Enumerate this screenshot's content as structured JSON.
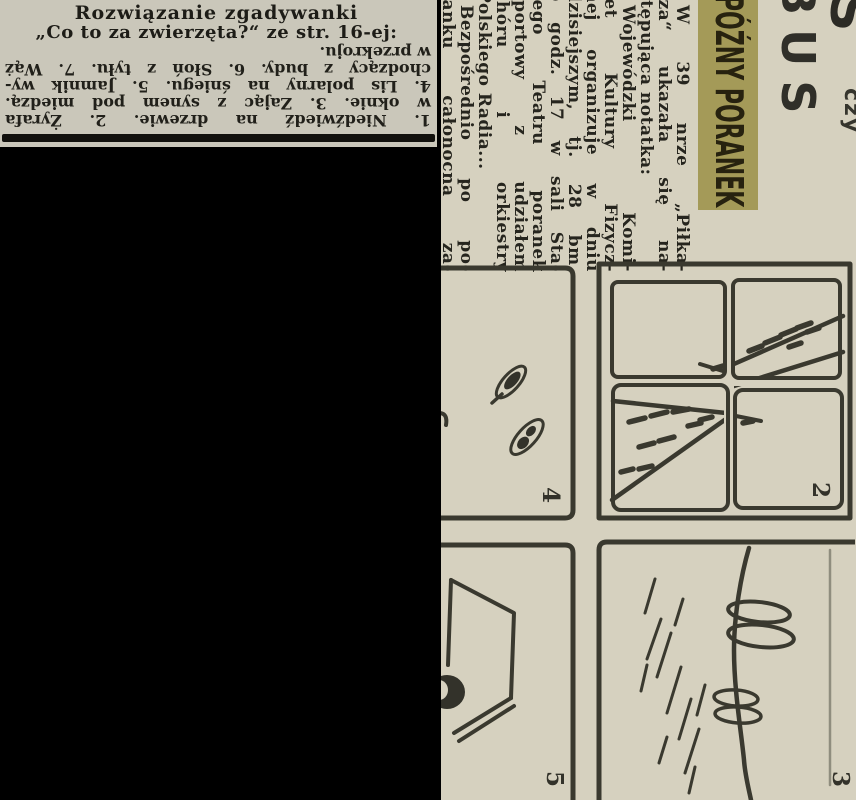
{
  "clipping": {
    "title_line1": "Rozwiązanie zgadywanki",
    "title_line2": "„Co to za zwierzęta?“ ze str. 16-ej:",
    "answer_lines": [
      "1. Niedźwiedź na drzewie. 2. Żyrafa",
      "w oknie. 3. Zając z synem pod miedzą.",
      "4. Lis polarny na śniegu. 5. Jamnik wy-",
      "chodzący z budy. 6. Słoń z tyłu. 7. Wąż",
      "w przekroju."
    ]
  },
  "magazine_page": {
    "masthead_fragment": "BUS",
    "edge_fragment_large": "S",
    "edge_fragment_small": "czy",
    "headline": "PÓŹNY PORANEK",
    "article_lines": [
      "W 39 nrze „Piłka-",
      "rza“ ukazała się na-",
      "stępująca notatka:",
      "Wojewódzki Komi-",
      "tet Kultury Fizycz-",
      "nej organizuje w dniu",
      "dzisiejszym, tj. 28 bm.",
      "o godz. 17 w sali Sta-",
      "rego Teatru poranek",
      "sportowy z udziałem",
      "chóru i orkiestry",
      "Polskiego Radia...",
      "Bezpośrednio po po-",
      "ranku całonocna za-"
    ],
    "panels": [
      {
        "number": "2"
      },
      {
        "number": "3"
      },
      {
        "number": "4"
      },
      {
        "number": "5"
      }
    ]
  },
  "colors": {
    "background": "#000000",
    "clipping_paper": "#cac7ba",
    "page_paper": "#d6d1bf",
    "ink": "#26251e",
    "headline_highlight": "#a49a58"
  }
}
